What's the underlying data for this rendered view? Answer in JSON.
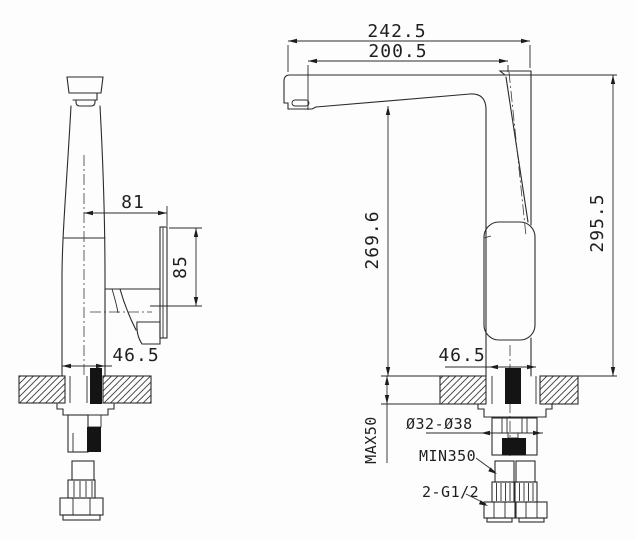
{
  "drawing": {
    "title": "Kitchen faucet two-view installation dimension drawing",
    "views": {
      "left": "front view",
      "right": "side view"
    }
  },
  "dimensions": {
    "overall_reach": "242.5",
    "spout_reach": "200.5",
    "spout_height": "269.6",
    "overall_height": "295.5",
    "handle_offset": "81",
    "handle_length": "85",
    "base_width_front": "46.5",
    "base_width_side": "46.5",
    "deck_thickness_max": "MAX50",
    "hole_diameter_range": "Ø32-Ø38",
    "hose_length_min": "MIN350",
    "thread_spec": "2-G1/2"
  }
}
